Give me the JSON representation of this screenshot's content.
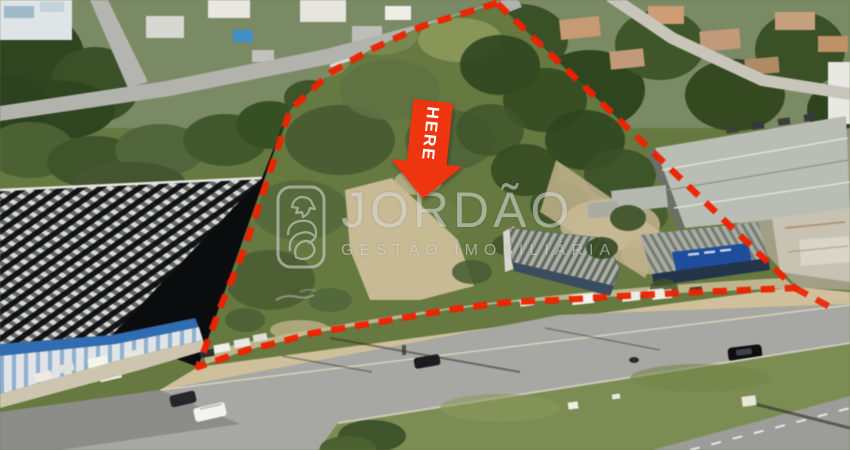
{
  "marker": {
    "label": "HERE"
  },
  "watermark": {
    "brand": "JORDÃO",
    "subtitle": "GESTÃO IMOBILIÁRIA",
    "logo_icon": "rooster-emblem-icon"
  },
  "boundary": {
    "style": "dashed",
    "color": "#f12000"
  },
  "colors": {
    "boundary_red": "#f12000",
    "marker_red": "#ef3410",
    "marker_text": "#ffffff",
    "watermark_gray": "#d8d8d8",
    "lot_green": "#66793f",
    "lot_green_dark": "#44552e",
    "lot_green_light": "#8e9b5f",
    "tree_green": "#2f451f",
    "sand": "#cfc09a",
    "road_gray": "#a7a8a3",
    "grass_median": "#7c8d52",
    "roof_dark": "#141517",
    "roof_stripe_light": "#d9d9d5",
    "fascia_blue": "#2f6cb4",
    "sign_blue": "#1d4d9e",
    "warehouse_roof": "#b9bdb3",
    "house_white": "#e9e8e0",
    "house_tan": "#c79a72"
  }
}
